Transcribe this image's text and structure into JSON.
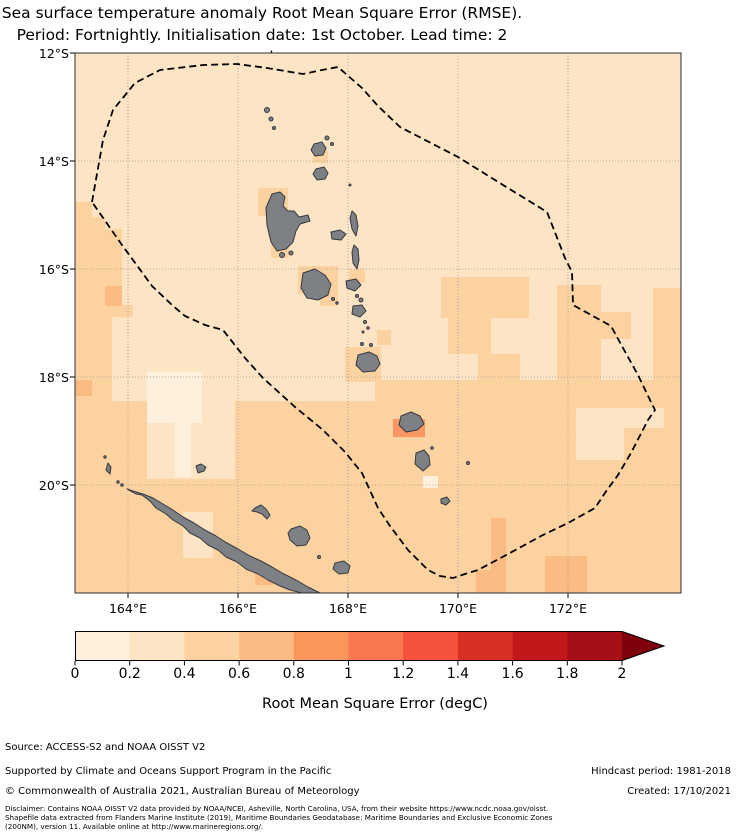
{
  "title": {
    "line1": "Sea surface temperature anomaly Root Mean Square Error (RMSE).",
    "line2": "Period: Fortnightly. Initialisation date: 1st October. Lead time: 2 weeks"
  },
  "map": {
    "lat_tick_labels": [
      "12°S",
      "14°S",
      "16°S",
      "18°S",
      "20°S"
    ],
    "lon_tick_labels": [
      "164°E",
      "166°E",
      "168°E",
      "170°E",
      "172°E"
    ]
  },
  "map_colors": {
    "ocean_base": "#fce4c4",
    "rmse_00_02": "#fdf0dd",
    "rmse_04_06": "#fcd2a0",
    "rmse_06_08": "#fbbb82",
    "rmse_08_10": "#f99663",
    "island_fill": "#7d8084",
    "island_outline": "#36393d",
    "eez_boundary": "#000000",
    "gridline": "#9a9a9a"
  },
  "colorbar": {
    "label": "Root Mean Square Error (degC)",
    "tick_labels": [
      "0",
      "0.2",
      "0.4",
      "0.6",
      "0.8",
      "1",
      "1.2",
      "1.4",
      "1.6",
      "1.8",
      "2"
    ],
    "segment_colors": [
      "#fdf0dd",
      "#fce4c4",
      "#fcd2a0",
      "#fbbb82",
      "#fa9659",
      "#f97850",
      "#f5523b",
      "#d92f24",
      "#c4171c",
      "#a50f15"
    ],
    "extend_color": "#7f000d"
  },
  "footer": {
    "source": "Source: ACCESS-S2 and NOAA OISST V2",
    "supported": "Supported by Climate and Oceans Support Program in the Pacific",
    "hindcast": "Hindcast period: 1981-2018",
    "copyright": "© Commonwealth of Australia 2021, Australian Bureau of Meteorology",
    "created": "Created: 17/10/2021",
    "disclaimer_line1": "Disclaimer: Contains NOAA OISST V2 data provided by NOAA/NCEI, Asheville, North Carolina, USA, from their website https://www.ncdc.noaa.gov/oisst.",
    "disclaimer_line2": "Shapefile data extracted from Flanders Marine Institute (2019), Maritime Boundaries Geodatabase: Maritime Boundaries and Exclusive Economic Zones",
    "disclaimer_line3": "(200NM), version 11. Available online at http://www.marineregions.org/."
  },
  "chart_data": {
    "type": "heatmap",
    "title": "Sea surface temperature anomaly Root Mean Square Error (RMSE). Period: Fortnightly. Initialisation date: 1st October. Lead time: 2 weeks",
    "x_ticks": [
      "164°E",
      "166°E",
      "168°E",
      "170°E",
      "172°E"
    ],
    "y_ticks": [
      "12°S",
      "14°S",
      "16°S",
      "18°S",
      "20°S"
    ],
    "x_range_deg_east": [
      163.0,
      174.0
    ],
    "y_range_deg_south": [
      12.0,
      22.1
    ],
    "colorbar": {
      "label": "Root Mean Square Error (degC)",
      "range": [
        0,
        2
      ],
      "step": 0.2,
      "extend": "max"
    },
    "grid": true,
    "overlays": [
      "dashed EEZ boundary polygon around Vanuatu",
      "gray land masses (Vanuatu chain, New Caledonia)"
    ],
    "values_summary": [
      {
        "region": "northern/central EEZ (north of ~18S)",
        "rmse_degC": [
          0.2,
          0.4
        ]
      },
      {
        "region": "southern area incl. around New Caledonia (south of ~18.5S)",
        "rmse_degC": [
          0.4,
          0.6
        ]
      },
      {
        "region": "western edge 15-18S and eastern patches 16-18S near 172-174E",
        "rmse_degC": [
          0.4,
          0.6
        ]
      },
      {
        "region": "small coastal patches (Santo, Malekula, Gaua, Efate, SE New Caledonia) and far-south strips",
        "rmse_degC": [
          0.6,
          0.8
        ]
      },
      {
        "region": "patch at Erromango island",
        "rmse_degC": [
          0.8,
          1.0
        ]
      },
      {
        "region": "light patches NW of New Caledonia, below Tanna and near 172.5-173.5E 18.5-19.5S",
        "rmse_degC": [
          0.0,
          0.2
        ]
      }
    ]
  }
}
